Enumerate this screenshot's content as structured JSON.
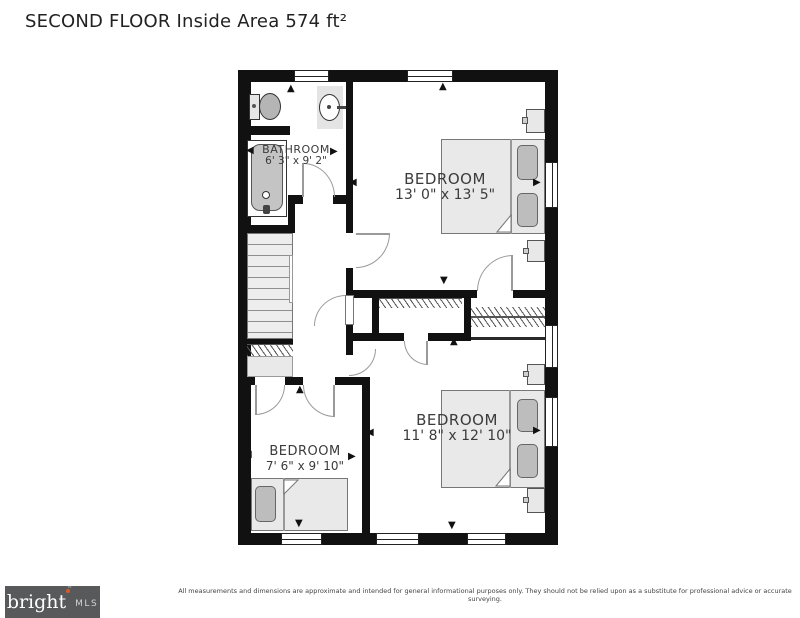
{
  "title": "SECOND FLOOR Inside Area 574 ft²",
  "rooms": {
    "bathroom": {
      "name": "BATHROOM",
      "dims": "6' 3\" x 9' 2\""
    },
    "bedroom_top": {
      "name": "BEDROOM",
      "dims": "13' 0\" x 13' 5\""
    },
    "bedroom_bottom_right": {
      "name": "BEDROOM",
      "dims": "11' 8\" x 12' 10\""
    },
    "bedroom_bottom_left": {
      "name": "BEDROOM",
      "dims": "7' 6\" x 9' 10\""
    }
  },
  "footer": {
    "logo_text": "bright",
    "logo_tm": "™",
    "logo_suffix": "MLS",
    "disclaimer": "All measurements and dimensions are approximate and intended for general informational purposes only. They should not be relied upon as a substitute for professional advice or accurate surveying."
  },
  "colors": {
    "wall": "#111111",
    "accent_dot": "#d85a2a",
    "logo_bg": "#58595b"
  },
  "icons": {
    "dimension_arrows": {
      "up": "▲",
      "down": "▼",
      "left": "◀",
      "right": "▶"
    }
  },
  "arrows": [
    {
      "room": "bathroom",
      "dir": "up",
      "x": 287,
      "y": 84
    },
    {
      "room": "bathroom",
      "dir": "left",
      "x": 246,
      "y": 146
    },
    {
      "room": "bathroom",
      "dir": "right",
      "x": 330,
      "y": 147
    },
    {
      "room": "bedroom_top",
      "dir": "up",
      "x": 439,
      "y": 82
    },
    {
      "room": "bedroom_top",
      "dir": "left",
      "x": 349,
      "y": 178
    },
    {
      "room": "bedroom_top",
      "dir": "right",
      "x": 533,
      "y": 178
    },
    {
      "room": "bedroom_top",
      "dir": "down",
      "x": 440,
      "y": 276
    },
    {
      "room": "bedroom_bottom_right",
      "dir": "up",
      "x": 450,
      "y": 337
    },
    {
      "room": "bedroom_bottom_right",
      "dir": "left",
      "x": 366,
      "y": 428
    },
    {
      "room": "bedroom_bottom_right",
      "dir": "right",
      "x": 533,
      "y": 426
    },
    {
      "room": "bedroom_bottom_right",
      "dir": "down",
      "x": 448,
      "y": 521
    },
    {
      "room": "bedroom_bottom_left",
      "dir": "up",
      "x": 296,
      "y": 385
    },
    {
      "room": "bedroom_bottom_left",
      "dir": "left",
      "x": 244,
      "y": 450
    },
    {
      "room": "bedroom_bottom_left",
      "dir": "right",
      "x": 348,
      "y": 452
    },
    {
      "room": "bedroom_bottom_left",
      "dir": "down",
      "x": 295,
      "y": 519
    }
  ]
}
